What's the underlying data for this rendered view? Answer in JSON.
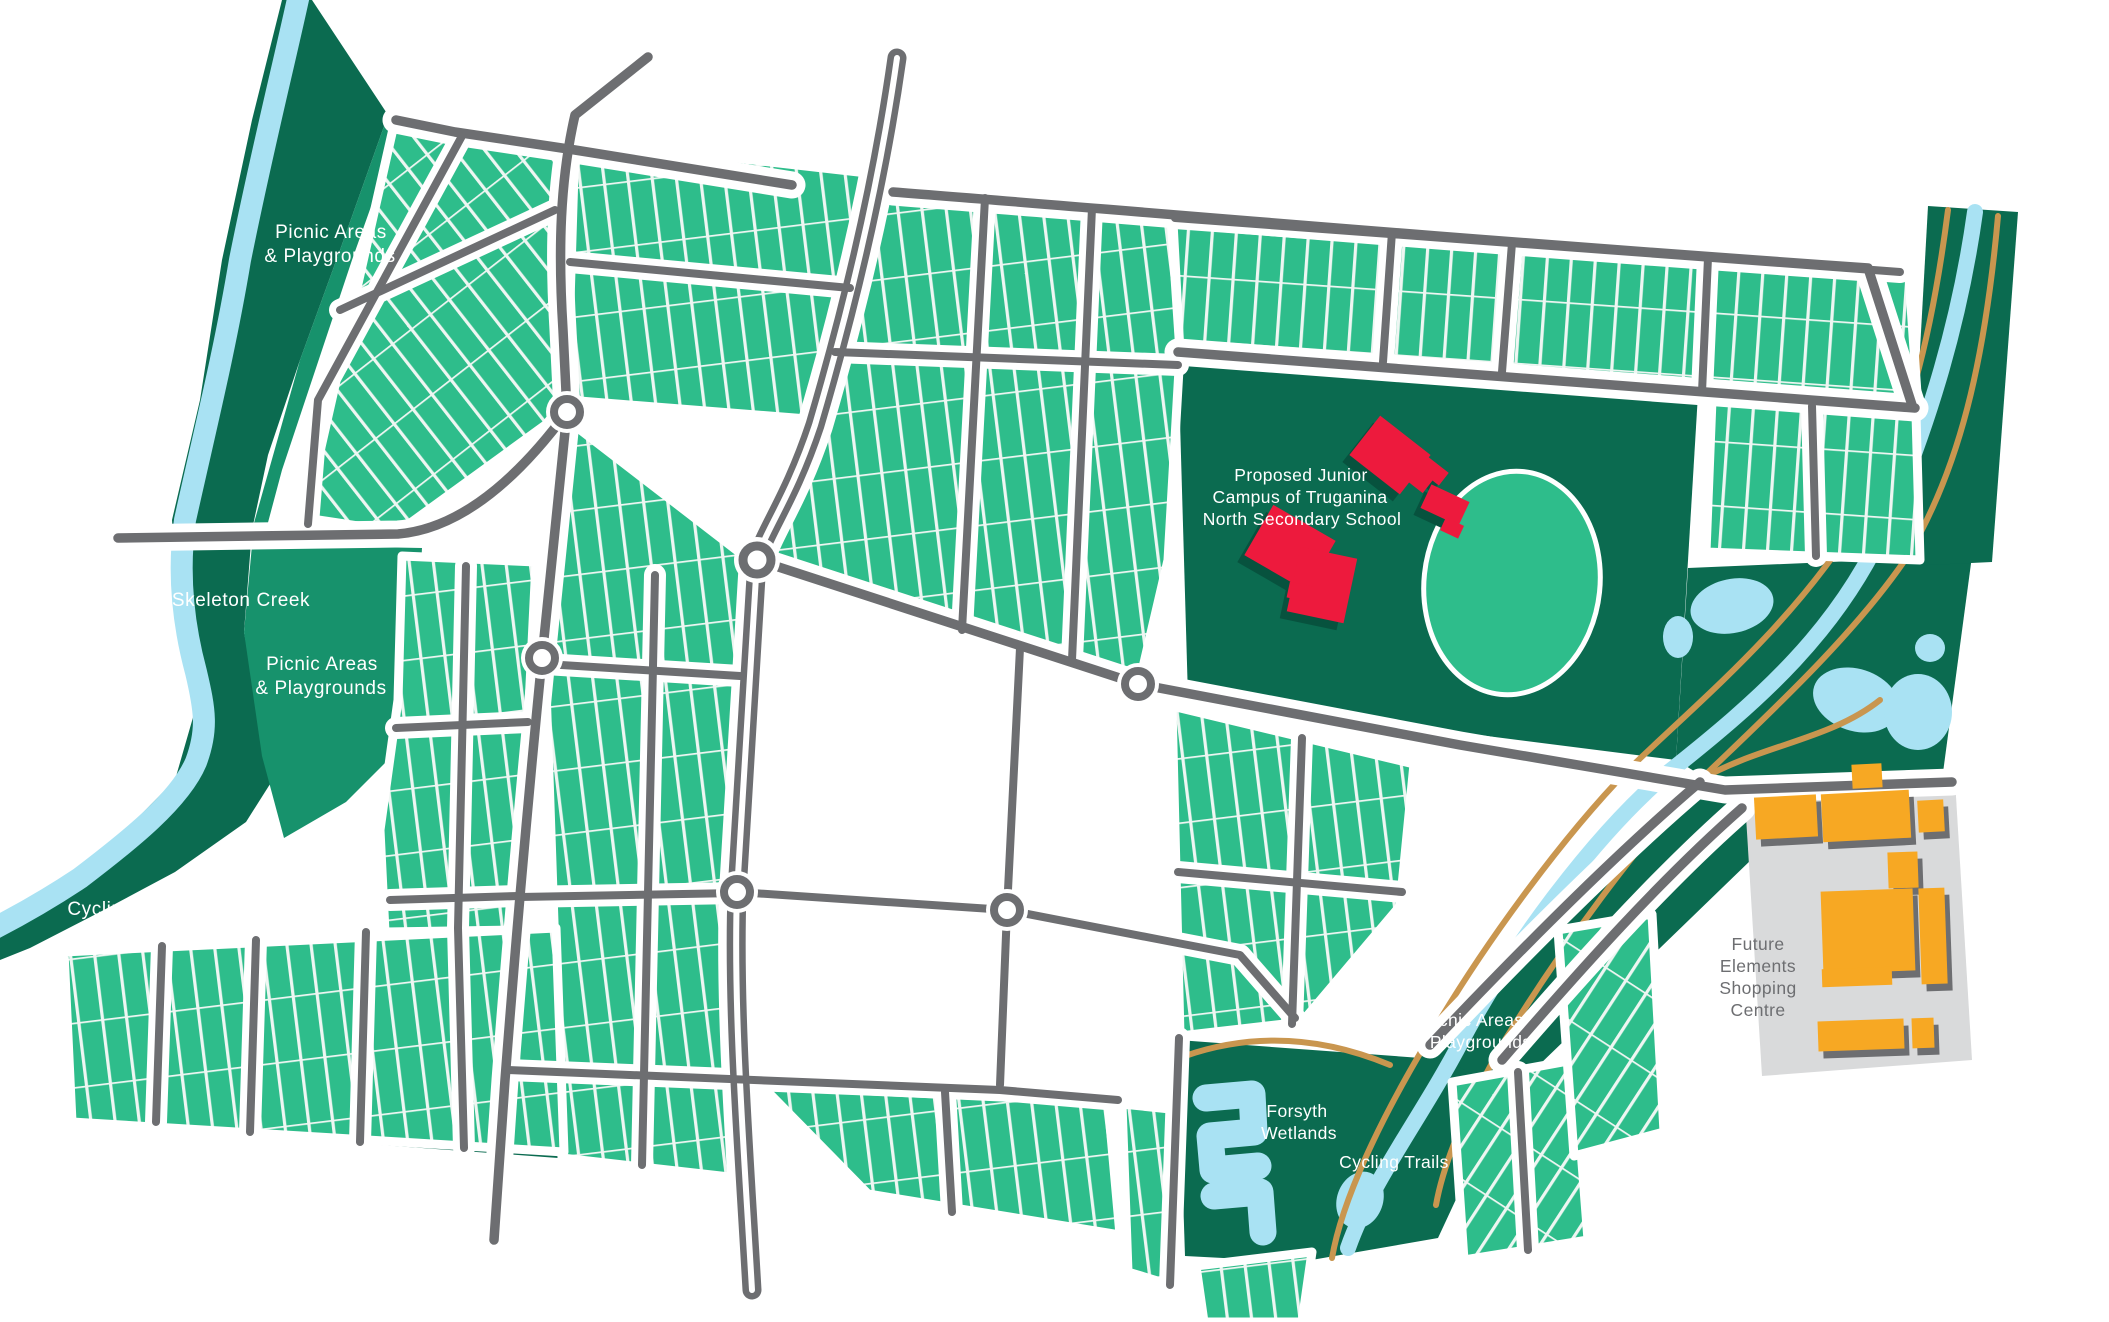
{
  "labels": {
    "picnic_nw": {
      "line1": "Picnic Areas",
      "line2": "& Playgrounds"
    },
    "skeleton_creek": {
      "text": "Skeleton Creek"
    },
    "picnic_w": {
      "line1": "Picnic Areas",
      "line2": "& Playgrounds"
    },
    "cycling_w": {
      "text": "Cycling Trails"
    },
    "school": {
      "line1": "Proposed Junior",
      "line2": "Campus of Truganina",
      "line3": "North Secondary School"
    },
    "shopping": {
      "line1": "Future",
      "line2": "Elements",
      "line3": "Shopping",
      "line4": "Centre"
    },
    "picnic_se": {
      "line1": "Picnic Areas",
      "line2": "& Playgrounds"
    },
    "forsyth": {
      "line1": "Forsyth",
      "line2": "Wetlands"
    },
    "cycling_se": {
      "text": "Cycling Trails"
    }
  },
  "colors": {
    "parcel_green": "#2ebd8b",
    "reserve_dark_green": "#0b6b50",
    "corridor_mid_green": "#17926c",
    "creek_blue": "#a9e2f3",
    "road_gray": "#6d6e71",
    "trail_tan": "#c9964f",
    "school_building_red": "#ed1a3d",
    "shopping_building_orange": "#f7a823",
    "shopping_ground_gray": "#d9dadb",
    "lot_line_white": "#eef6f2",
    "label_white": "#ffffff",
    "label_gray": "#6d6e71"
  }
}
